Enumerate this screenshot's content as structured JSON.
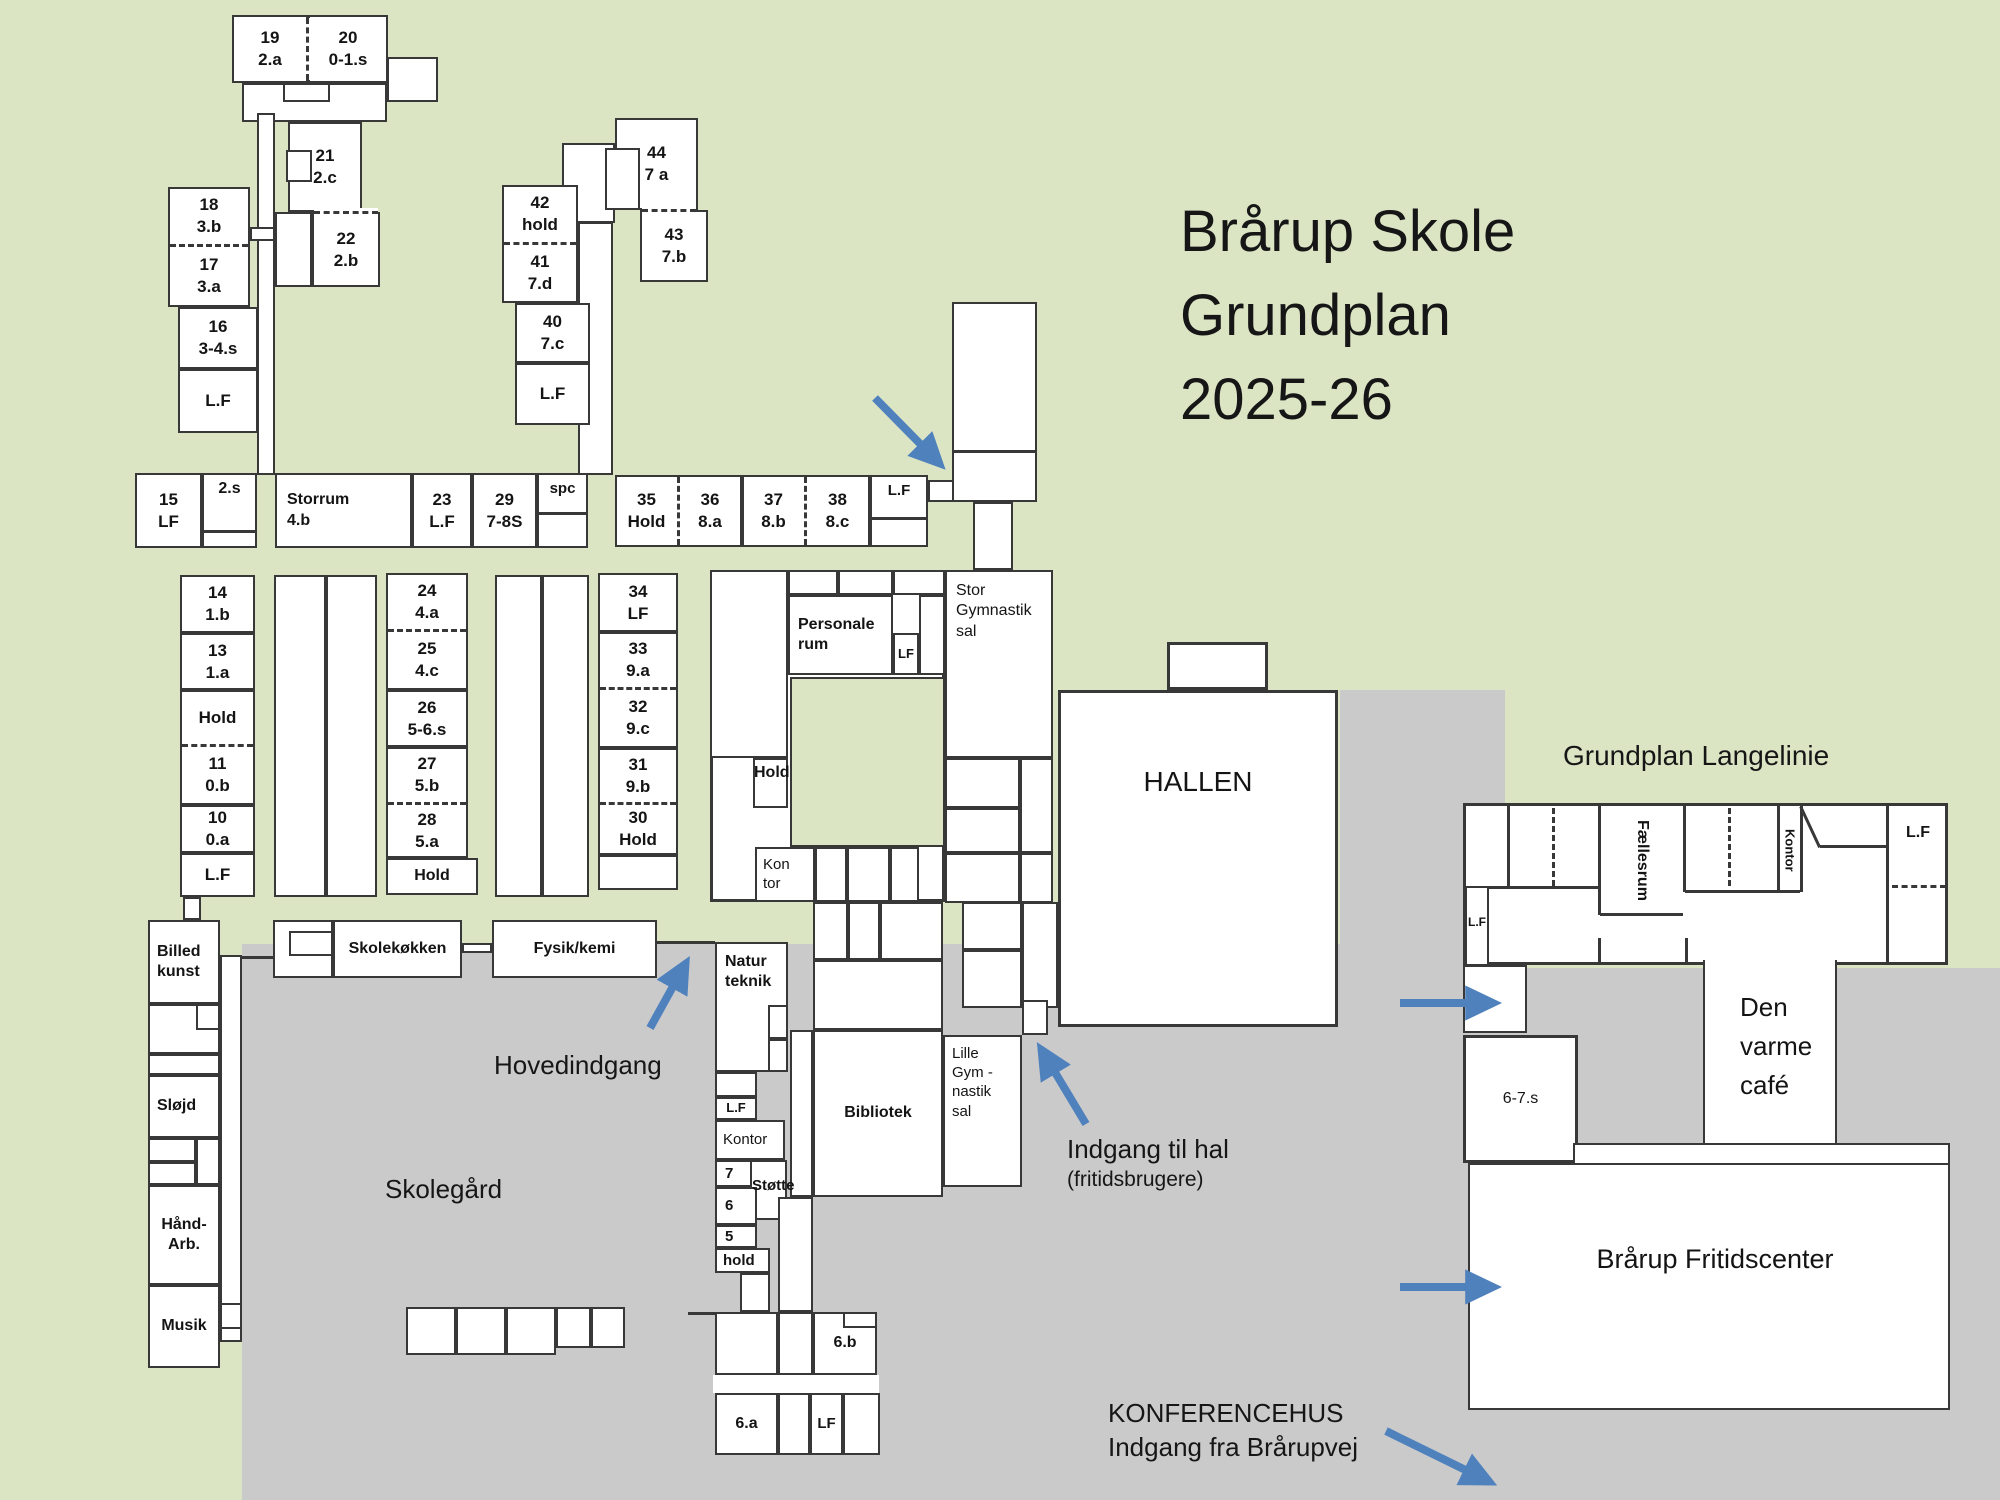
{
  "page": {
    "title": "Brårup Skole Grundplan 2025-26"
  },
  "colors": {
    "background_green": "#dbe5c4",
    "paved_gray": "#cacaca",
    "wall": "#383838",
    "room_fill": "#ffffff",
    "arrow_blue": "#4f81bd",
    "text": "#161616"
  },
  "texts": {
    "title": "Brårup Skole\nGrundplan\n2025-26",
    "langelinie_heading": "Grundplan Langelinie",
    "hovedindgang": "Hovedindgang",
    "skolegaard": "Skolegård",
    "indgang_til_hal": "Indgang til hal",
    "indgang_til_hal_sub": "(fritidsbrugere)",
    "konferencehus": "KONFERENCEHUS\nIndgang fra Brårupvej"
  },
  "rooms": {
    "19": "19\n2.a",
    "20": "20\n0-1.s",
    "21": "21\n2.c",
    "22": "22\n2.b",
    "18": "18\n3.b",
    "17": "17\n3.a",
    "16": "16\n3-4.s",
    "lf_a": "L.F",
    "42": "42\nhold",
    "41": "41\n7.d",
    "44": "44\n7 a",
    "43": "43\n7.b",
    "40": "40\n7.c",
    "lf_b": "L.F",
    "15": "15\nLF",
    "2s": "2.s",
    "storrum": "Storrum\n4.b",
    "23": "23\nL.F",
    "29": "29\n7-8S",
    "spc": "spc",
    "35": "35\nHold",
    "36": "36\n8.a",
    "37": "37\n8.b",
    "38": "38\n8.c",
    "lf_c": "L.F",
    "14": "14\n1.b",
    "13": "13\n1.a",
    "hold_a": "Hold",
    "11": "11\n0.b",
    "10": "10\n0.a",
    "lf_d": "L.F",
    "24": "24\n4.a",
    "25": "25\n4.c",
    "26": "26\n5-6.s",
    "27": "27\n5.b",
    "28": "28\n5.a",
    "hold_b": "Hold",
    "34": "34\nLF",
    "33": "33\n9.a",
    "32": "32\n9.c",
    "31": "31\n9.b",
    "30": "30\nHold",
    "personale": "Personale\nrum",
    "lf_e": "LF",
    "hold_c": "Hold",
    "kontor_a": "Kon\ntor",
    "stor_gym": "Stor\nGymnastik\nsal",
    "hallen": "HALLEN",
    "billed": "Billed\nkunst",
    "slojd": "Sløjd",
    "haand": "Hånd-\nArb.",
    "musik": "Musik",
    "skolekokken": "Skolekøkken",
    "fysik": "Fysik/kemi",
    "natur": "Natur\nteknik",
    "lf_f": "L.F",
    "kontor_b": "Kontor",
    "7": "7",
    "stotte": "Støtte",
    "6": "6",
    "5": "5",
    "hold_d": "hold",
    "bibliotek": "Bibliotek",
    "lille_gym": "Lille\nGym -\nnastik\nsal",
    "6b": "6.b",
    "6a": "6.a",
    "lf_g": "LF",
    "faellesrum": "Fællesrum",
    "kontor_c": "Kontor",
    "lf_h": "L.F",
    "lf_i": "L.F",
    "67s": "6-7.s",
    "cafe": "Den\nvarme\ncafé",
    "fritidscenter": "Brårup Fritidscenter"
  }
}
